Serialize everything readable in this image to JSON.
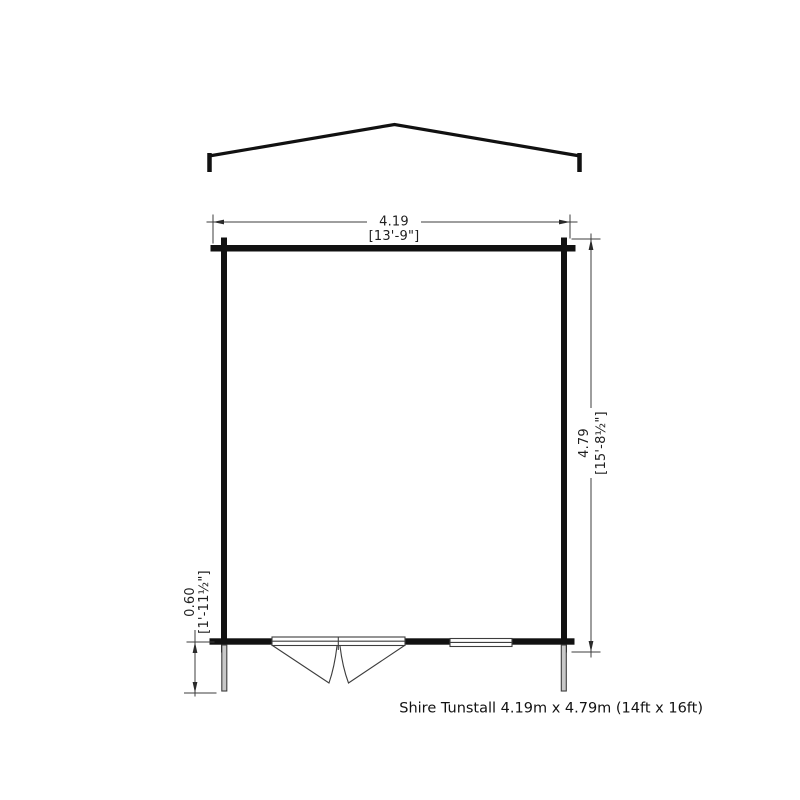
{
  "diagram": {
    "caption": "Shire Tunstall 4.19m x 4.79m (14ft x 16ft)",
    "dim_width": {
      "metric": "4.19",
      "imperial": "[13'-9\"]"
    },
    "dim_depth": {
      "metric": "4.79",
      "imperial": "[15'-8½\"]"
    },
    "dim_door_projection": {
      "metric": "0.60",
      "imperial": "[1'-11½\"]"
    },
    "colors": {
      "wall": "#111111",
      "roof": "#111111",
      "dim_line": "#3d3d3d",
      "detail_line": "#3d3d3d",
      "dim_text": "#1f1f1f",
      "post_fill": "#c8c8c8",
      "background": "#ffffff"
    }
  }
}
